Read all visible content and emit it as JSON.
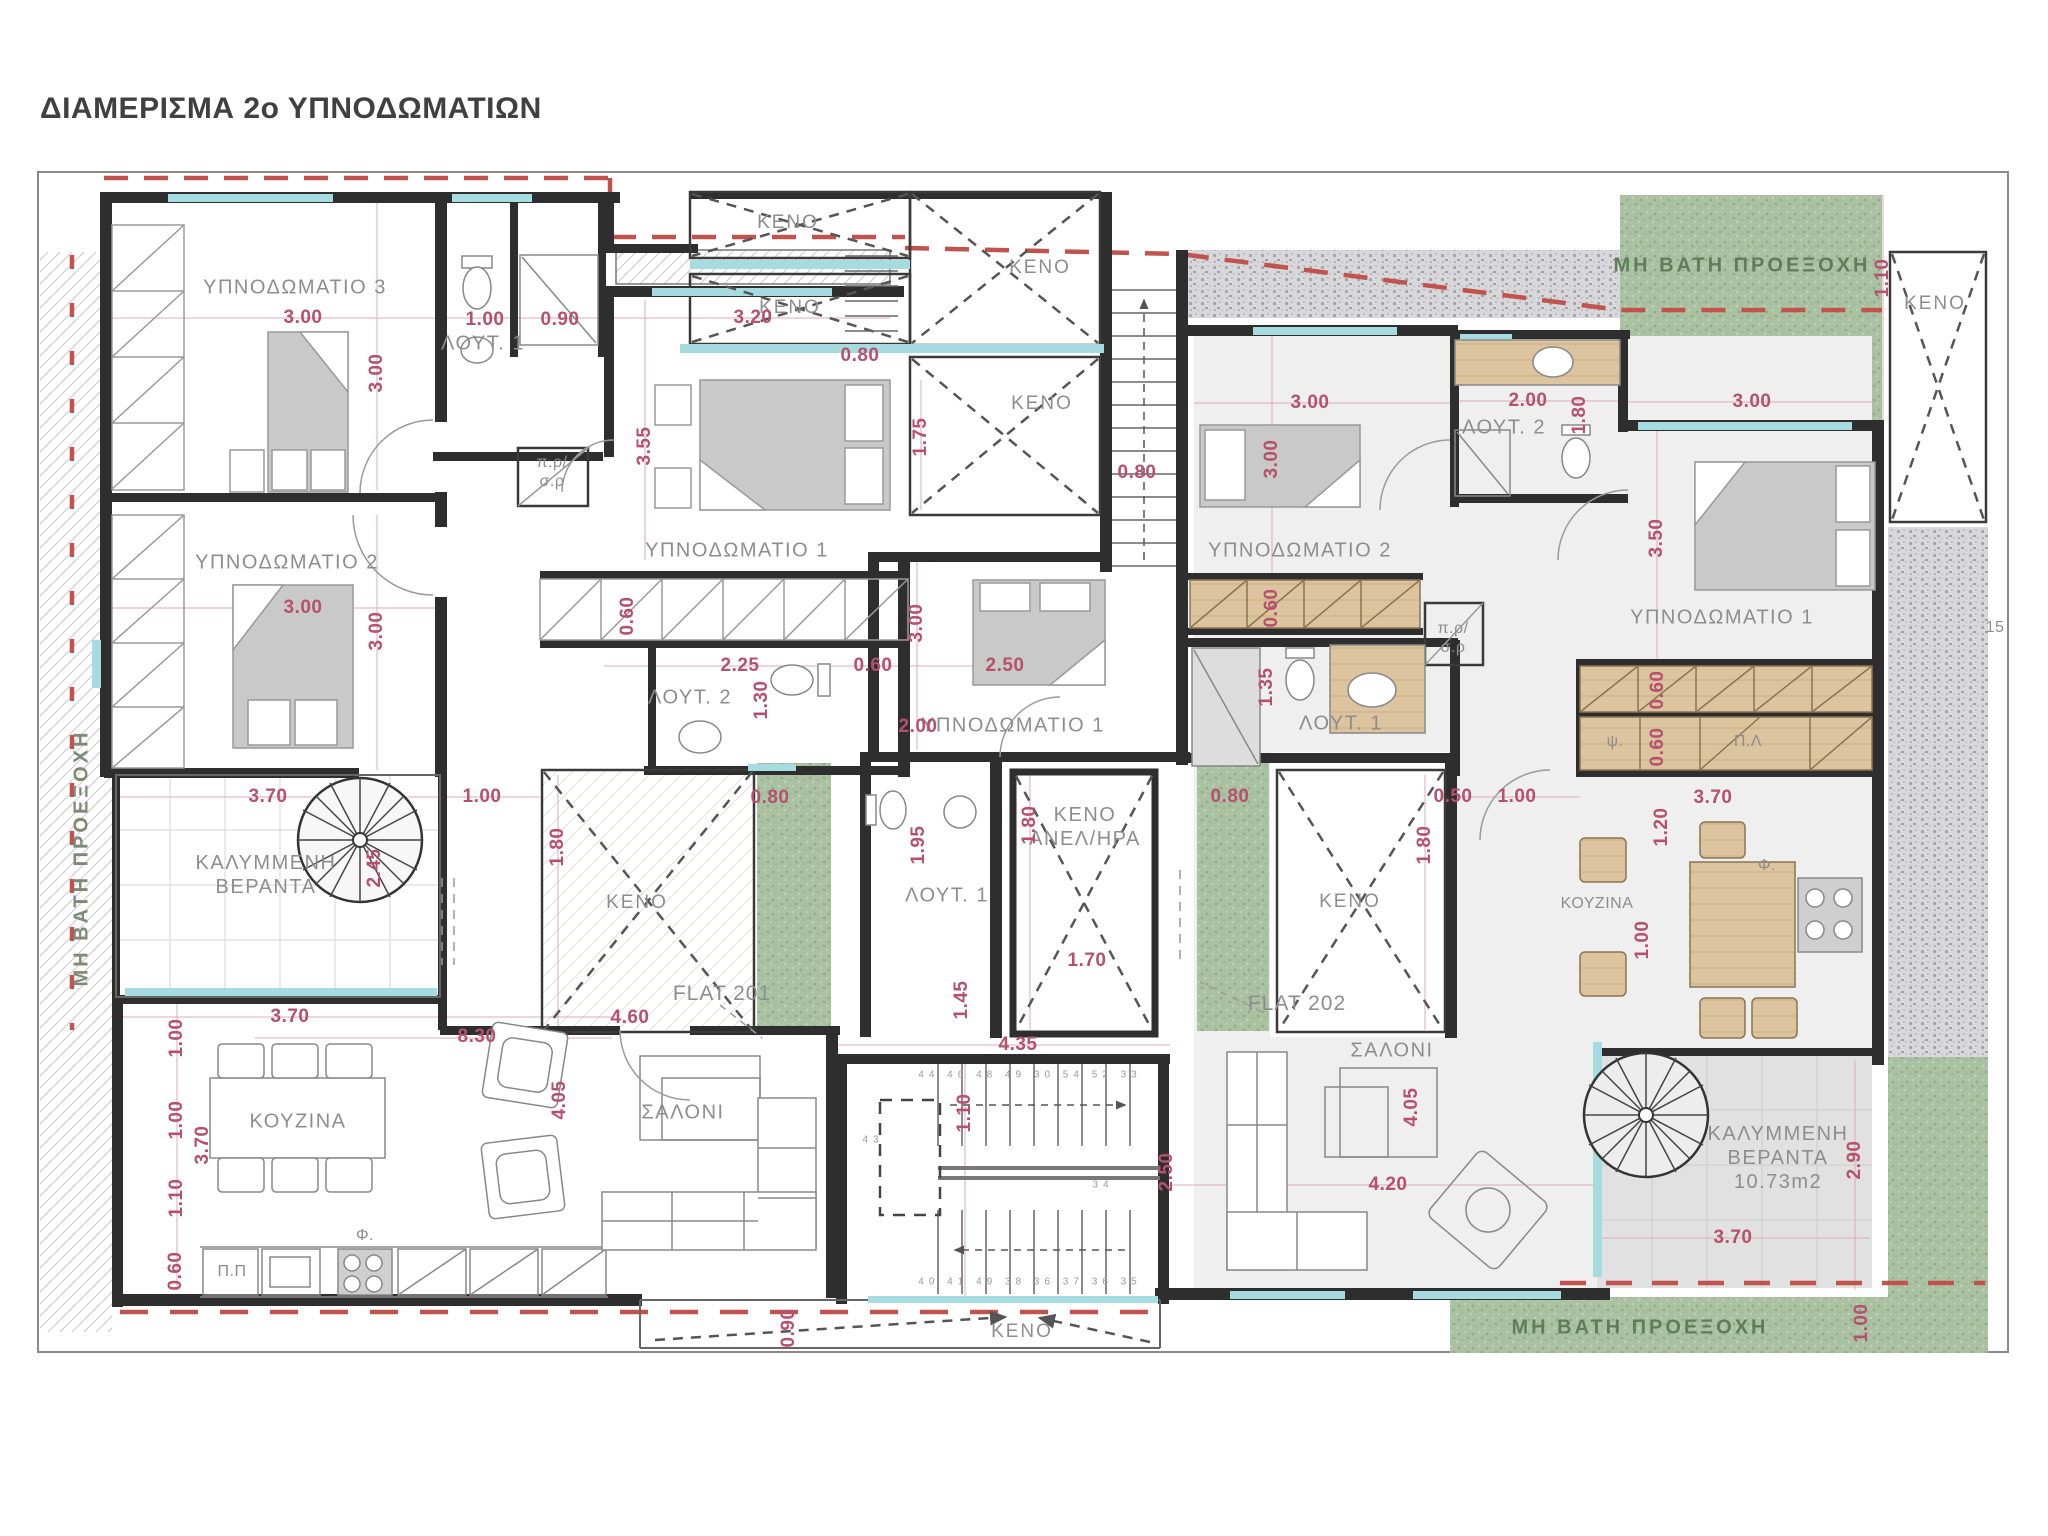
{
  "title": "ΔΙΑΜΕΡΙΣΜΑ 2ο ΥΠΝΟΔΩΜΑΤΙΩΝ",
  "flats": {
    "left": "FLAT 201",
    "right": "FLAT 202"
  },
  "rooms": {
    "f201_bed3": "ΥΠΝΟΔΩΜΑΤΙΟ 3",
    "f201_bed2": "ΥΠΝΟΔΩΜΑΤΙΟ 2",
    "f201_bed1": "ΥΠΝΟΔΩΜΑΤΙΟ 1",
    "f201_bed1_mid": "ΥΠΝΟΔΩΜΑΤΙΟ 1",
    "f201_lout1": "ΛΟΥΤ. 1",
    "f201_lout2": "ΛΟΥΤ. 2",
    "f201_saloni": "ΣΑΛΟΝΙ",
    "f201_kouzina": "ΚΟΥΖΙΝΑ",
    "f201_ver1": "ΚΑΛΥΜΜΕΝΗ",
    "f201_ver2": "ΒΕΡΑΝΤΑ",
    "mid_lout1": "ΛΟΥΤ. 1",
    "elev1": "ΚΕΝΟ",
    "elev2": "ΑΝΕΛ/ΗΡΑ",
    "keno": "ΚΕΝΟ",
    "prsr1": "π.ρ/",
    "prsr2": "σ.ρ",
    "f202_bed2": "ΥΠΝΟΔΩΜΑΤΙΟ 2",
    "f202_bed1": "ΥΠΝΟΔΩΜΑΤΙΟ 1",
    "f202_lout1": "ΛΟΥΤ. 1",
    "f202_lout2": "ΛΟΥΤ. 2",
    "f202_saloni": "ΣΑΛΟΝΙ",
    "f202_kouzina": "ΚΟΥΖΙΝΑ",
    "f202_ver1": "ΚΑΛΥΜΜΕΝΗ",
    "f202_ver2": "ΒΕΡΑΝΤΑ",
    "f202_ver3": "10.73m2",
    "mh": "ΜΗ ΒΑΤΗ ΠΡΟΕΞΟΧΗ",
    "pp": "Π.Π",
    "pl": "Π.Λ",
    "psi": "ψ.",
    "fi": "Φ."
  },
  "dims": {
    "d3_00a": "3.00",
    "d3_00b": "3.00",
    "d1_00a": "1.00",
    "d0_90": "0.90",
    "d3_20": "3.20",
    "d3_55": "3.55",
    "d3_00c": "3.00",
    "d3_00d": "3.00",
    "d0_60a": "0.60",
    "d2_25": "2.25",
    "d1_30": "1.30",
    "d0_60b": "0.60",
    "d3_00e": "3.00",
    "d2_50a": "2.50",
    "d2_00a": "2.00",
    "d1_75": "1.75",
    "d0_80a": "0.80",
    "d1_10a": "1.10",
    "d3_00f": "3.00",
    "d3_00g": "3.00",
    "d0_80b": "0.80",
    "d2_00b": "2.00",
    "d1_80a": "1.80",
    "d3_00h": "3.00",
    "d3_50": "3.50",
    "d0_60c": "0.60",
    "d1_35": "1.35",
    "d1_80b": "1.80",
    "d0_80c": "0.80",
    "d1_80c": "1.80",
    "d1_70": "1.70",
    "d1_95": "1.95",
    "d0_80d": "0.80",
    "d1_80d": "1.80",
    "d0_50": "0.50",
    "d1_00b": "1.00",
    "d1_00c": "1.00",
    "d3_70a": "3.70",
    "d2_45": "2.45",
    "d3_70b": "3.70",
    "d1_00d": "1.00",
    "d1_00e": "1.00",
    "d3_70c": "3.70",
    "d1_10b": "1.10",
    "d0_60d": "0.60",
    "d8_30": "8.30",
    "d4_60": "4.60",
    "d4_05a": "4.05",
    "d4_35": "4.35",
    "d1_45": "1.45",
    "d1_10c": "1.10",
    "d2_50b": "2.50",
    "d0_90b": "0.90",
    "d4_05b": "4.05",
    "d4_20": "4.20",
    "d0_60e": "0.60",
    "d0_60f": "0.60",
    "d3_70d": "3.70",
    "d1_20": "1.20",
    "d1_00f": "1.00",
    "d2_90": "2.90",
    "d3_70e": "3.70",
    "d1_00g": "1.00"
  },
  "notes": {
    "n15": "15",
    "stair_top": "44 46 48 49 30 54 52 33",
    "stair_bottom": "40 41 49 38 36 37 36 35",
    "s43": "43",
    "s34": "34"
  }
}
